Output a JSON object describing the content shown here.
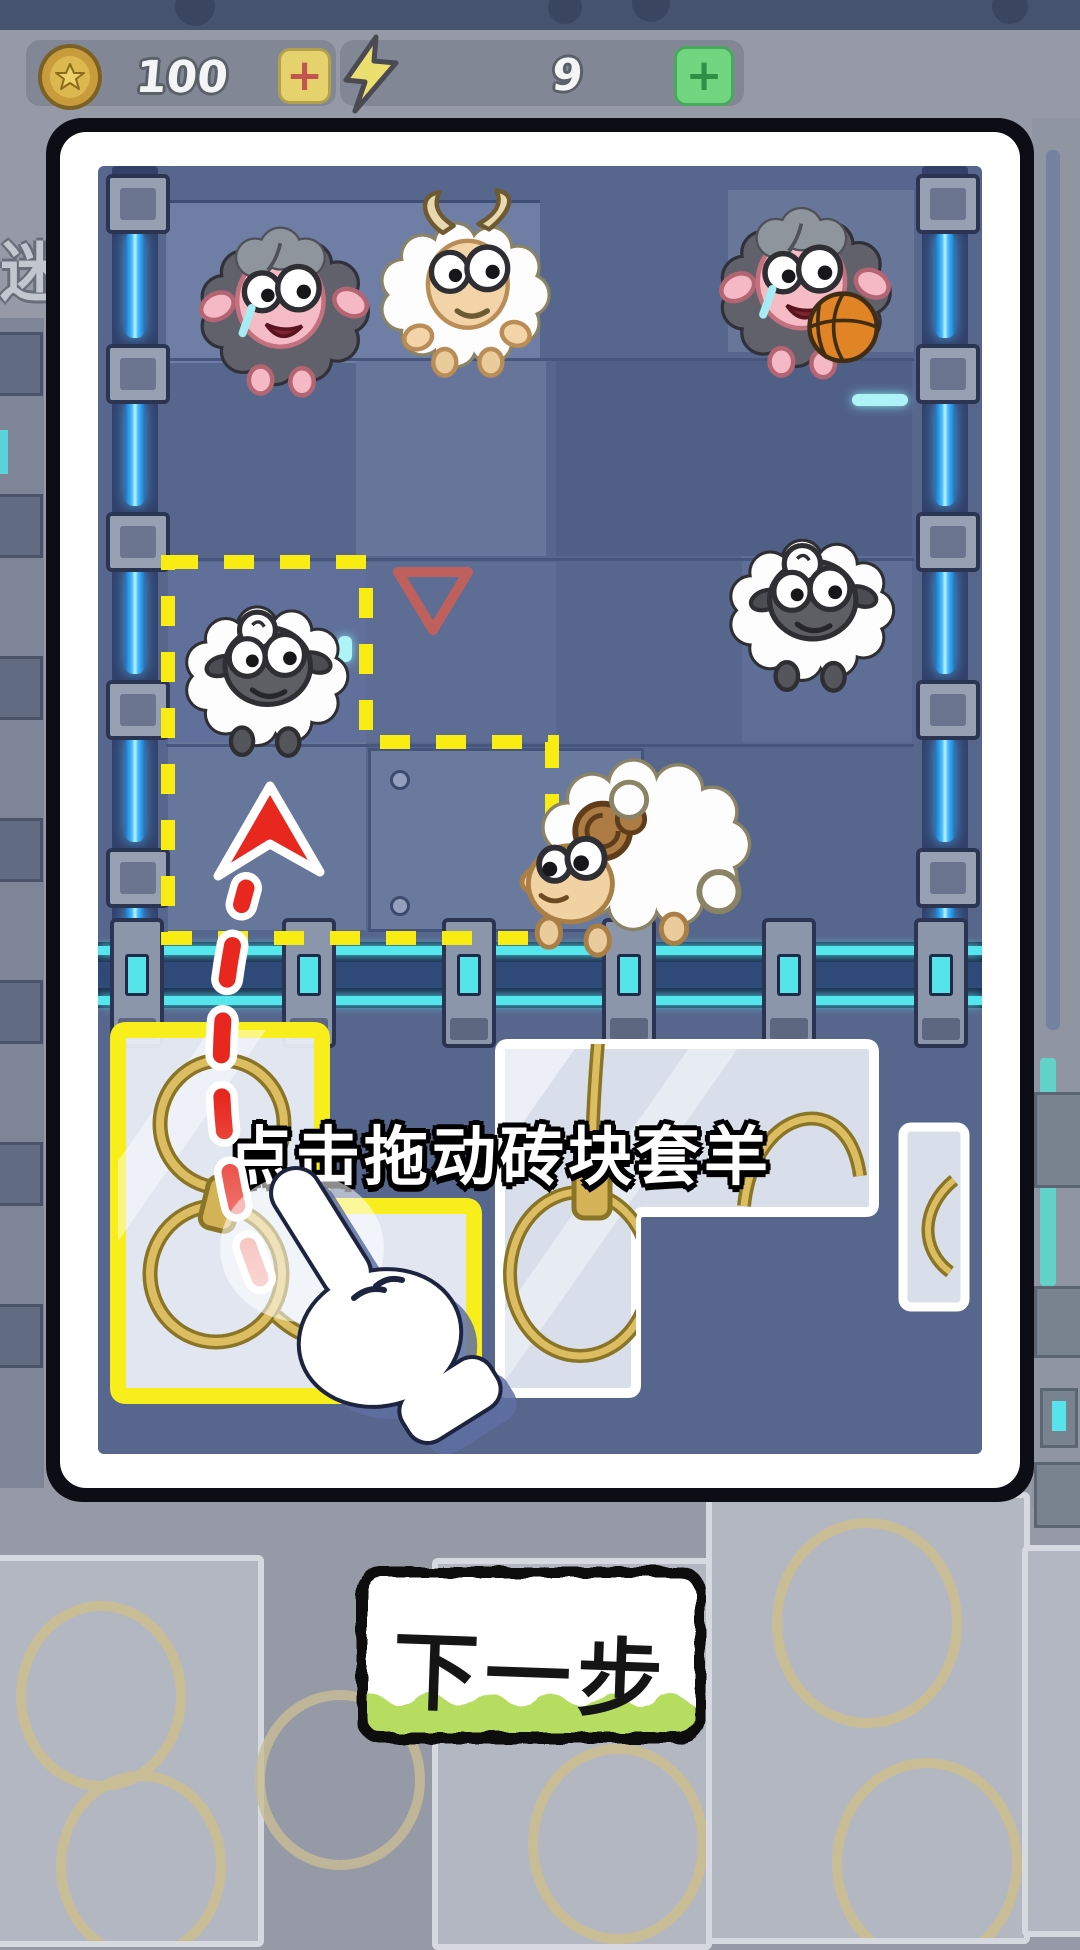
{
  "hud": {
    "coins": {
      "icon": "coin-star-icon",
      "value": "100",
      "add_label": "+"
    },
    "energy": {
      "icon": "lightning-icon",
      "value": "9",
      "add_label": "+"
    }
  },
  "background": {
    "partial_label": "迷"
  },
  "tutorial": {
    "hint_text": "点击拖动砖块套羊",
    "next_button_label": "下一步"
  },
  "board": {
    "marker": "red-triangle-marker",
    "selection": "yellow-dashed-drop-zone",
    "sheep": [
      {
        "name": "dark-sheep",
        "type": "dark",
        "x": 185,
        "y": 200,
        "w": 198,
        "h": 198
      },
      {
        "name": "white-goat",
        "type": "goat",
        "x": 365,
        "y": 185,
        "w": 195,
        "h": 195
      },
      {
        "name": "dark-sheep-basketball",
        "type": "dark_basketball",
        "x": 705,
        "y": 180,
        "w": 200,
        "h": 200
      },
      {
        "name": "white-sheep-selected",
        "type": "white",
        "x": 172,
        "y": 572,
        "w": 188,
        "h": 188
      },
      {
        "name": "white-sheep",
        "type": "white",
        "x": 716,
        "y": 505,
        "w": 190,
        "h": 190
      },
      {
        "name": "ram-sheep",
        "type": "ram",
        "x": 505,
        "y": 745,
        "w": 250,
        "h": 215
      }
    ],
    "tray_pieces": [
      {
        "name": "tray-piece-highlighted",
        "outline": "#f8ee1c"
      },
      {
        "name": "tray-piece-middle",
        "outline": "#ffffff"
      },
      {
        "name": "tray-piece-right",
        "outline": "#ffffff"
      }
    ]
  },
  "colors": {
    "accent_yellow": "#f8ee1c",
    "arrow_red": "#e8281e",
    "button_green": "#b6dd60",
    "rail_blue": "#42bdff",
    "rope_tan": "#d9b75a",
    "board_bg": "#57668c"
  }
}
